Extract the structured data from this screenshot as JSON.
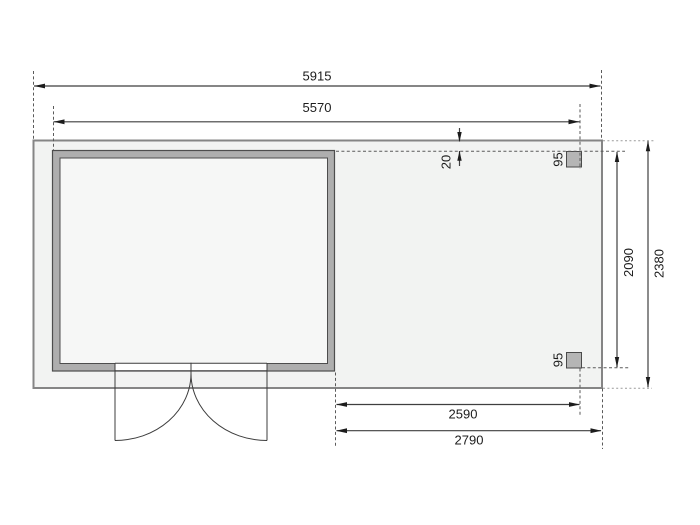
{
  "drawing": {
    "type": "floor-plan-with-dimensions",
    "dimensions": {
      "overall_width": "5915",
      "cabin_width": "5570",
      "edge_offset": "20",
      "post_top": "95",
      "post_bottom": "95",
      "canopy_inner_depth": "2090",
      "overall_depth": "2380",
      "canopy_inner_width": "2590",
      "canopy_width": "2790"
    },
    "colors": {
      "platform_fill": "#f2f3f2",
      "platform_stroke": "#858585",
      "wall_fill": "#aeaeae",
      "wall_stroke": "#4d4d4d",
      "interior_fill": "#f6f7f6",
      "post_fill": "#b5b5b5",
      "door_fill": "#ffffff"
    }
  }
}
